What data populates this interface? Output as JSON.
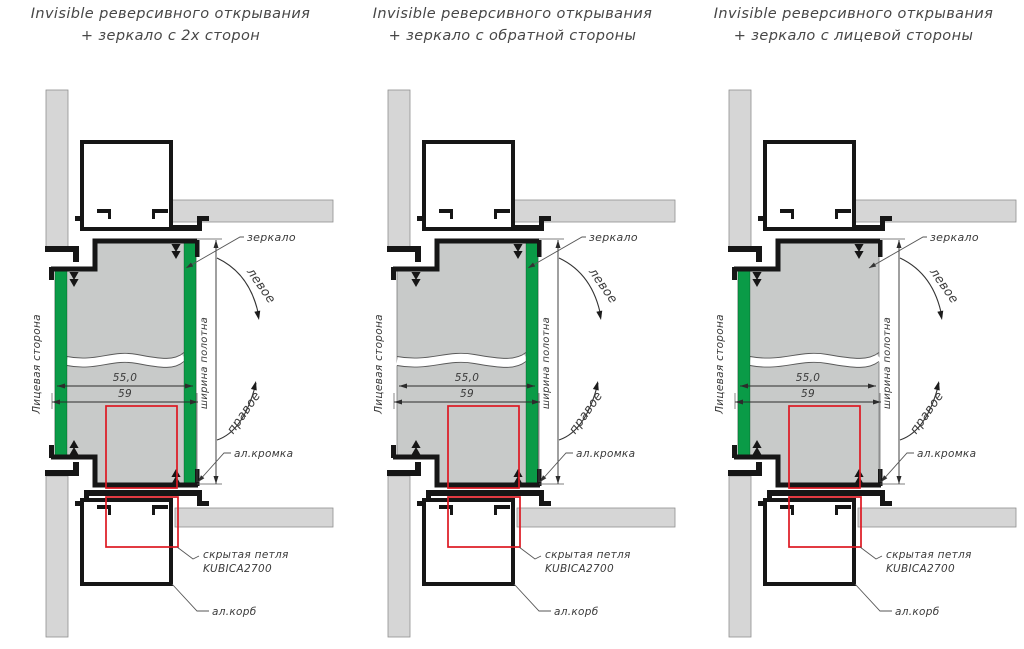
{
  "colors": {
    "green": "#0a9b47",
    "red": "#dd1822",
    "panel": "#c8cac9",
    "wall": "#d6d6d6",
    "outline": "#161616",
    "annotation": "#3a3a3a"
  },
  "labels": {
    "mirror": "зеркало",
    "swing_left": "левое",
    "swing_right": "правое",
    "al_edge": "ал.кромка",
    "hidden_hinge_line1": "скрытая петля",
    "hidden_hinge_line2": "KUBICA2700",
    "al_box": "ал.корб",
    "front_side": "Лицевая сторона",
    "panel_width": "ширина полотна",
    "dim_mirror_width": "55,0",
    "dim_outer_width": "59"
  },
  "diagrams": [
    {
      "title_line1": "Invisible реверсивного открывания",
      "title_line2": "+ зеркало с 2х сторон",
      "mirror_front": true,
      "mirror_back": true
    },
    {
      "title_line1": "Invisible реверсивного открывания",
      "title_line2": "+ зеркало с обратной стороны",
      "mirror_front": false,
      "mirror_back": true
    },
    {
      "title_line1": "Invisible реверсивного открывания",
      "title_line2": "+ зеркало с лицевой стороны",
      "mirror_front": true,
      "mirror_back": false
    }
  ]
}
